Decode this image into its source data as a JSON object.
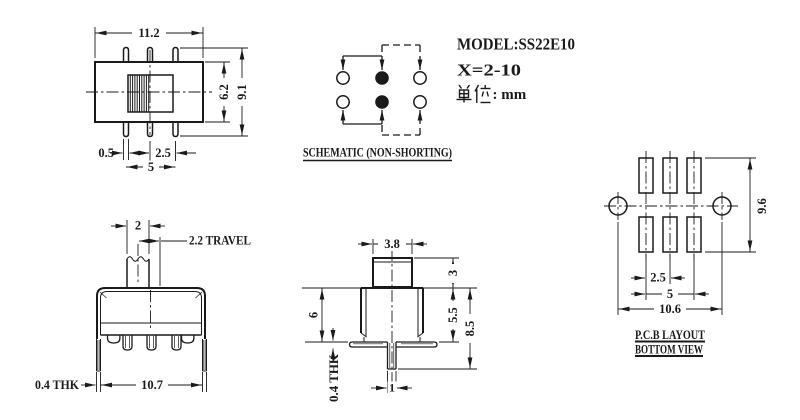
{
  "title_block": {
    "model": "MODEL:SS22E10",
    "variant": "X=2-10",
    "unit_cjk": "单位",
    "unit_text": ": mm"
  },
  "front_view": {
    "dim_width": "11.2",
    "dim_slot_height": "6.2",
    "dim_total_height": "9.1",
    "dim_pin_width": "0.5",
    "dim_pin_pitch": "2.5",
    "dim_pin_span": "5"
  },
  "schematic": {
    "caption": "SCHEMATIC (NON-SHORTING)"
  },
  "side_view": {
    "dim_knob_width": "2",
    "dim_travel": "2.2 TRAVEL",
    "dim_thickness": "0.4 THK",
    "dim_body_width": "10.7"
  },
  "end_view": {
    "dim_knob_width": "3.8",
    "dim_knob_height": "3",
    "dim_body_height": "5.5",
    "dim_total_height": "8.5",
    "dim_bracket_height": "6",
    "dim_thickness": "0.4 THK",
    "dim_pin_width": "1"
  },
  "pcb_view": {
    "dim_row_span": "9.6",
    "dim_pad_pitch": "2.5",
    "dim_pad_span": "5",
    "dim_hole_span": "10.6",
    "caption_line1": "P.C.B LAYOUT",
    "caption_line2": "BOTTOM VIEW"
  },
  "colors": {
    "line": "#1a1a1a",
    "background": "#ffffff"
  }
}
